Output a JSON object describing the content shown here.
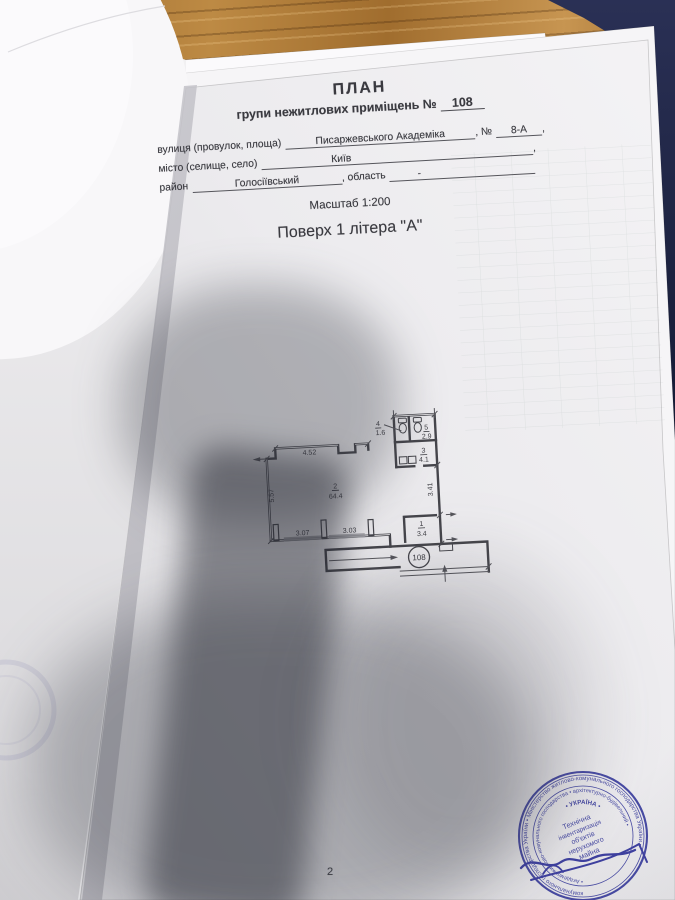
{
  "photo": {
    "wood_color": "#a9763a",
    "folder_color": "#1d2342",
    "paper_color": "#edecee",
    "stamp_color": "#3b3e9e"
  },
  "document": {
    "title": "ПЛАН",
    "subtitle_prefix": "групи нежитлових приміщень №",
    "group_number": "108",
    "address": {
      "street_label": "вулиця (провулок, площа)",
      "street_value": "Писаржевського Академіка",
      "number_label": ", №",
      "number_value": "8-А",
      "street_trailing": ",",
      "city_label": "місто (селище, село)",
      "city_value": "Київ",
      "city_trailing": ",",
      "district_label": "район",
      "district_value": "Голосіївський",
      "region_label": ", область",
      "region_value": "-"
    },
    "scale_line": "Масштаб 1:200",
    "floor_line": "Поверх 1 літера \"А\"",
    "page_number": "2"
  },
  "floor_plan": {
    "unit_label": "108",
    "rooms": {
      "main": {
        "number": "2",
        "area": "64.4"
      },
      "vestibule": {
        "number": "1",
        "area": "3.4"
      },
      "washroom": {
        "number": "3",
        "area": "4.1"
      },
      "wc_left": {
        "number": "4",
        "area": "1.6"
      },
      "wc_right": {
        "number": "5",
        "area": "2.9"
      }
    },
    "dims": {
      "top": "4.52",
      "left": "5.57",
      "bottom_left": "3.07",
      "bottom_right": "3.03",
      "right": "3.41"
    }
  },
  "stamp": {
    "ring_text": "комунального господарства України  •  Міністерство житлово-комунального господарства України  •",
    "ring2_text": "•  Академія житлово-комунального господарства  •  архітектурно-будівельний  •",
    "arc_text": "•  УКРАЇНА  •",
    "center_lines": [
      "Технічна",
      "інвентаризація",
      "об'єктів",
      "нерухомого",
      "майна"
    ]
  }
}
